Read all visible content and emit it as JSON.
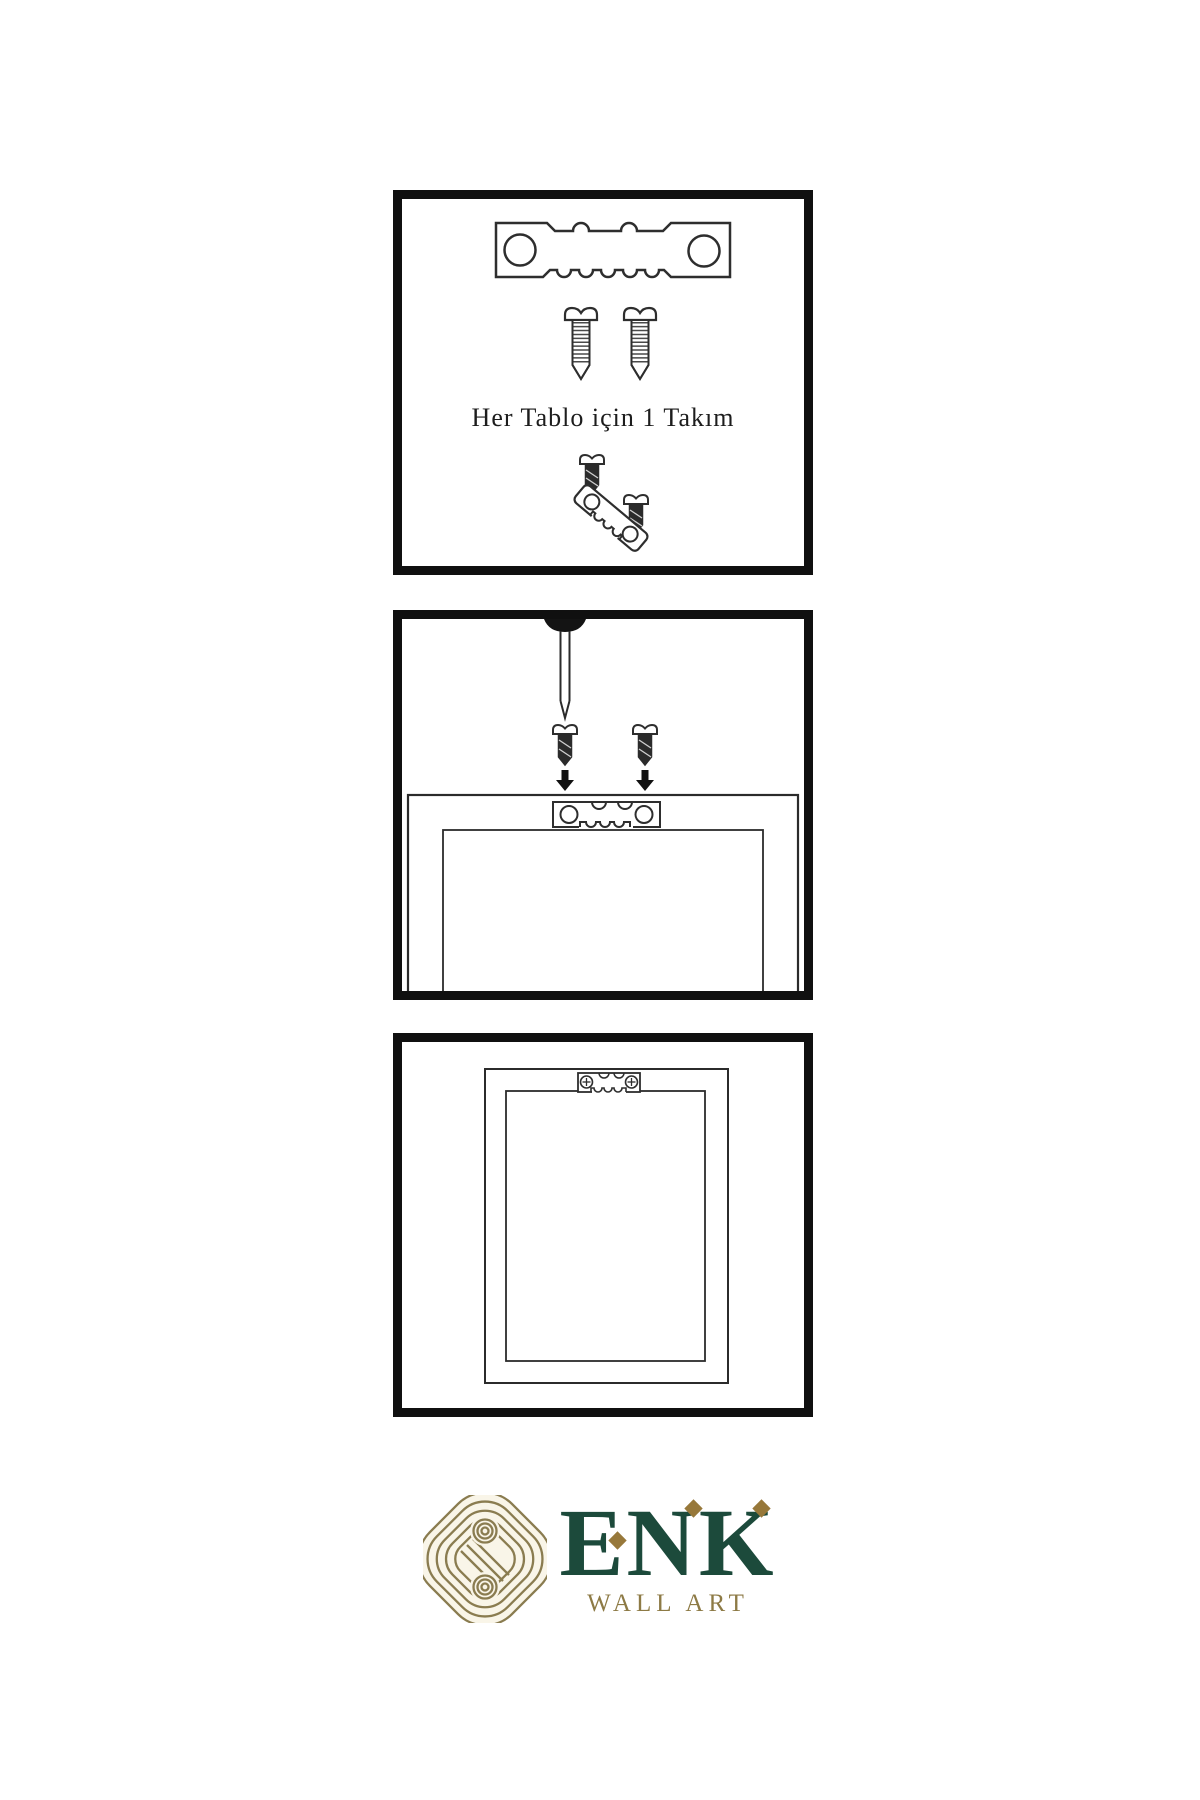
{
  "page": {
    "background_color": "#ffffff"
  },
  "panels": [
    {
      "id": "hardware-kit-step",
      "caption": "Her Tablo için 1 Takım"
    },
    {
      "id": "mount-hanger-step",
      "caption": ""
    },
    {
      "id": "hang-frame-step",
      "caption": ""
    }
  ],
  "icons": [
    "sawtooth-hanger-icon",
    "screw-icon",
    "dark-screw-icon",
    "angled-sawtooth-hanger-icon",
    "wall-nail-icon",
    "arrow-down-icon",
    "frame-back-icon",
    "installed-hanger-icon",
    "knot-logo-icon"
  ],
  "brand": {
    "name": "ENK",
    "subtitle": "WALL ART",
    "colors": {
      "green": "#1c4a3b",
      "gold": "#97783a",
      "knot_olive": "#8a7c50",
      "knot_cream": "#f9f5e8"
    }
  },
  "artwork_colors": {
    "panel_border": "#101010",
    "outline": "#2e2e2e",
    "dark_metal": "#2b2b2b"
  }
}
